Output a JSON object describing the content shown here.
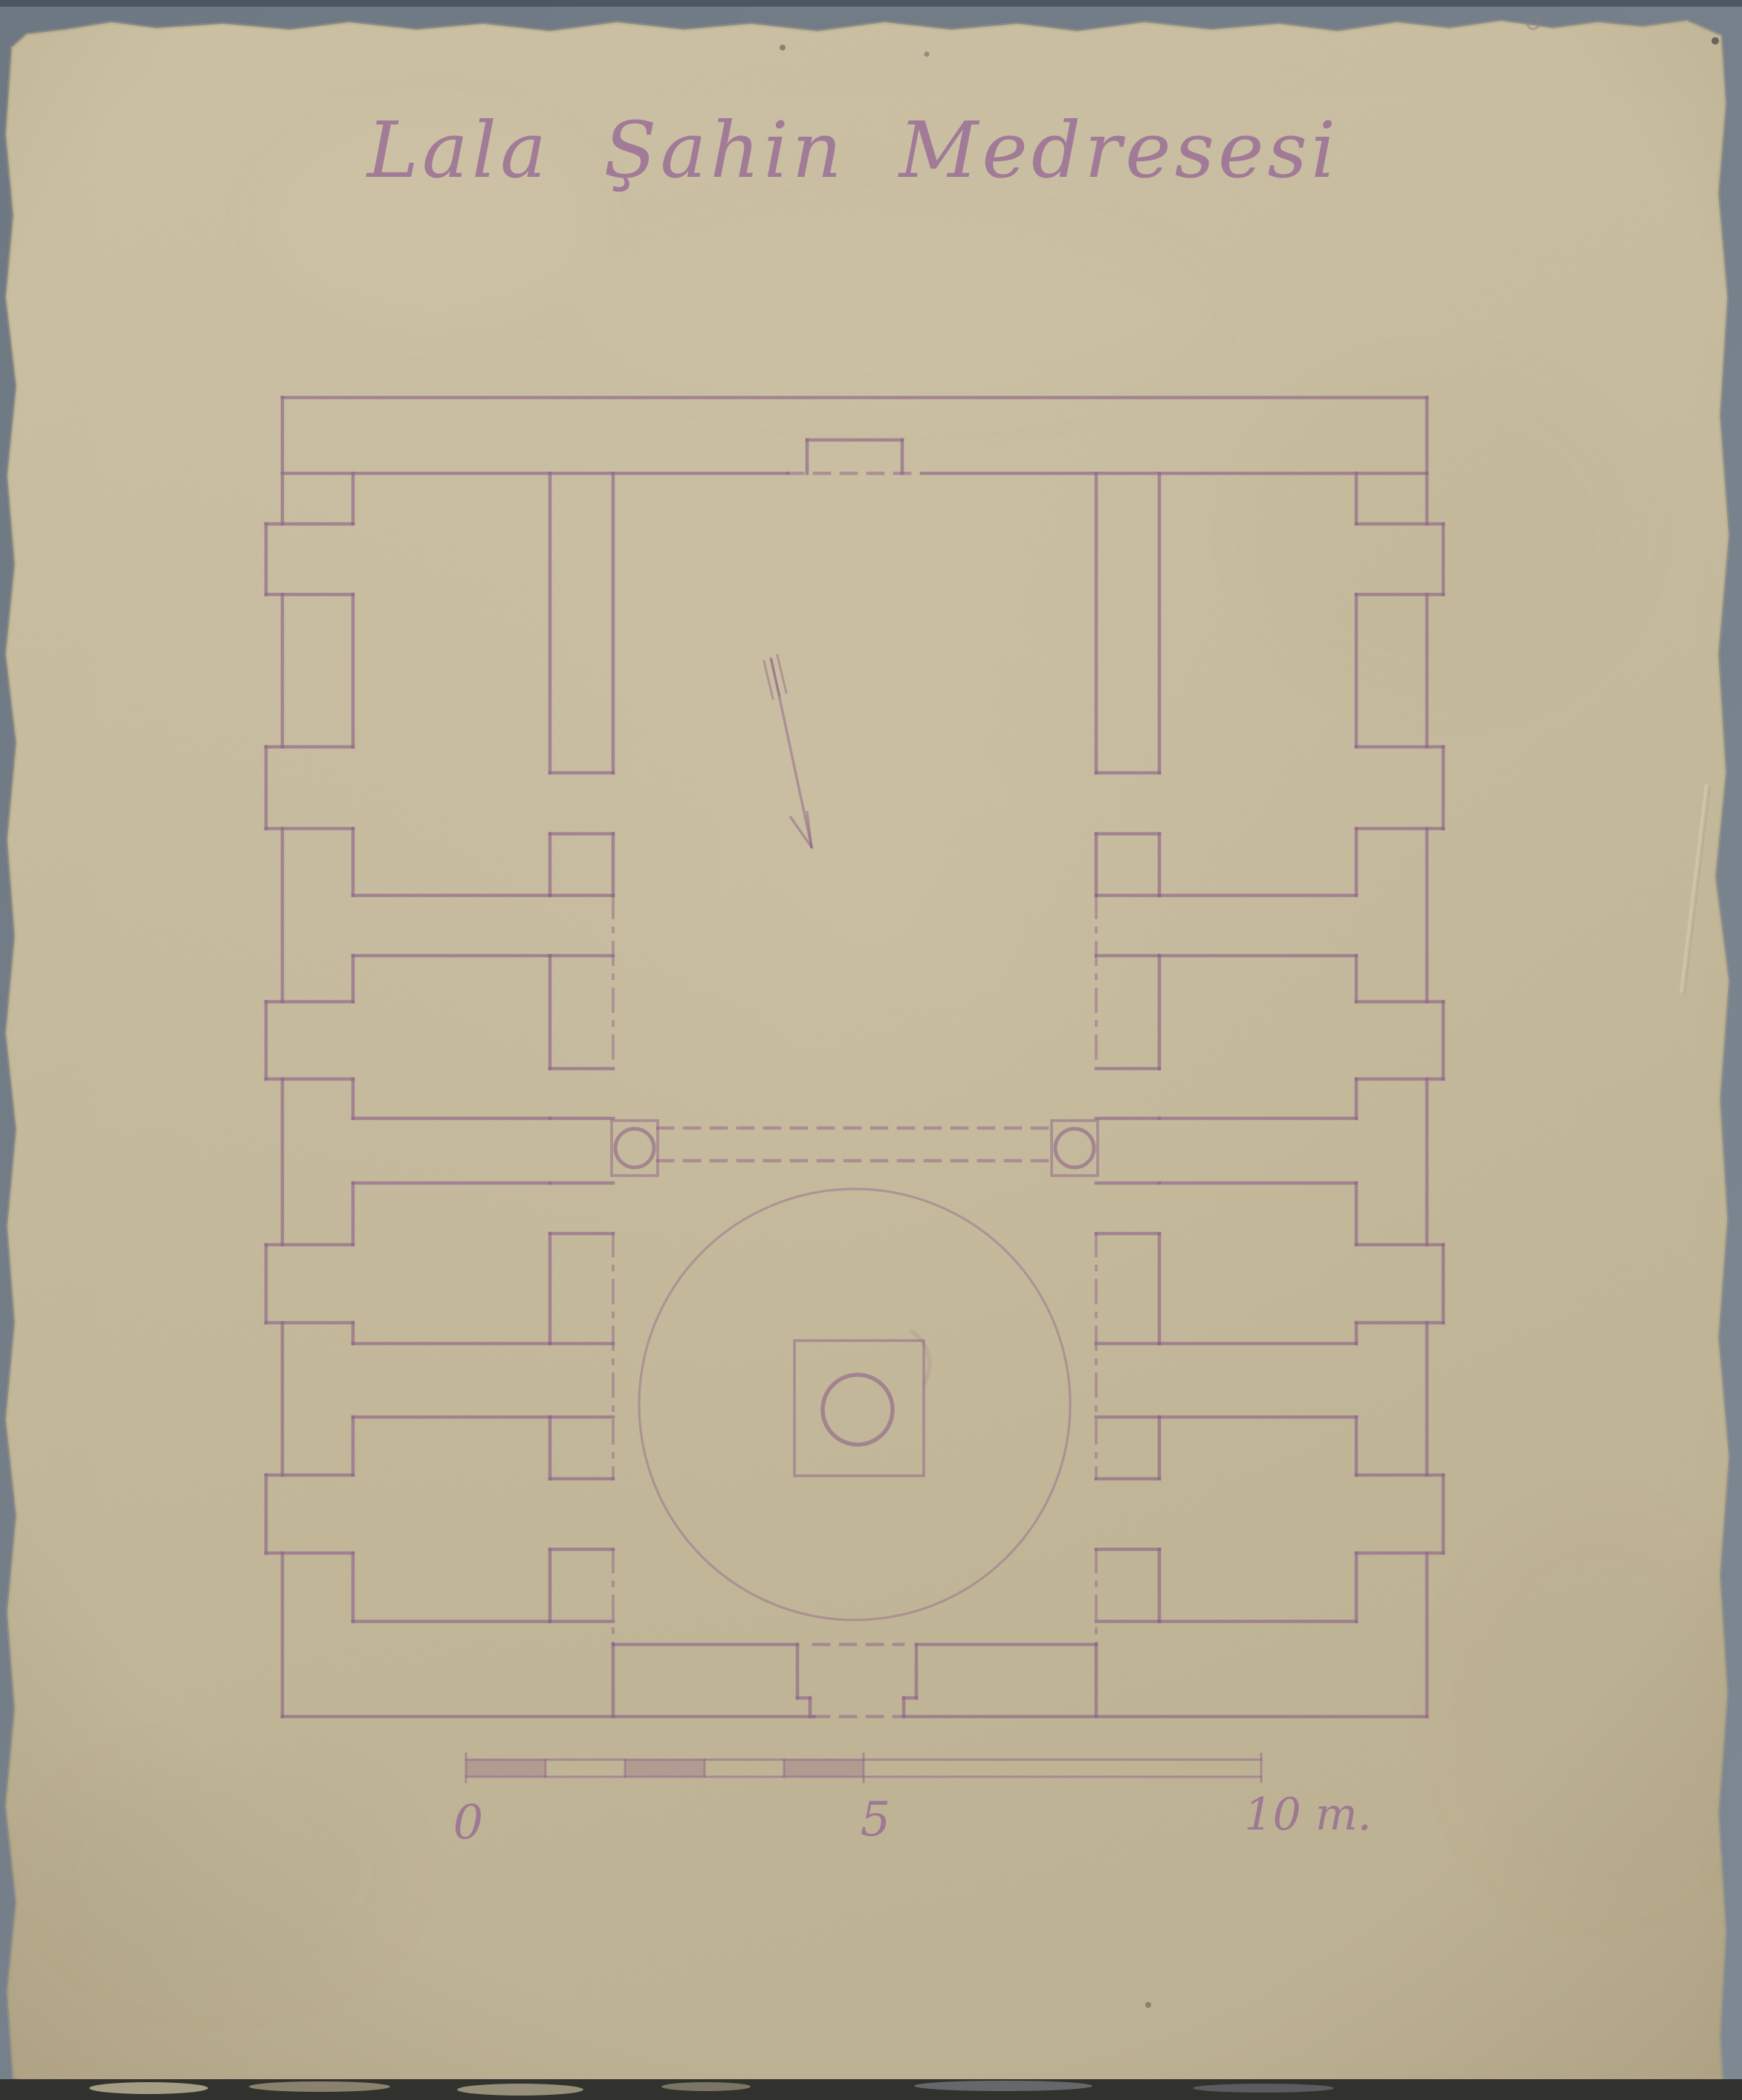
{
  "document": {
    "title": "Lala Şahin Medresesi",
    "scale_labels": {
      "zero": "0",
      "five": "5",
      "ten": "10 m."
    },
    "colors": {
      "background": "#75808b",
      "background_top_strip": "#49525c",
      "paper": "#cfc4a7",
      "paper_dark": "#c3b698",
      "ink": "#8d6287",
      "ink_faint": "#9c739a",
      "bottom_strip": "#31312d"
    }
  },
  "plan": {
    "wall_stroke_width": 4.6,
    "thin_stroke_width": 3.0,
    "solid_walls": [
      [
        380,
        535,
        1920,
        535
      ],
      [
        380,
        2310,
        1095,
        2310
      ],
      [
        1218,
        2310,
        1920,
        2310
      ],
      [
        380,
        535,
        380,
        705
      ],
      [
        380,
        800,
        380,
        1005
      ],
      [
        380,
        1115,
        380,
        1348
      ],
      [
        380,
        1452,
        380,
        1675
      ],
      [
        380,
        1780,
        380,
        1985
      ],
      [
        380,
        2090,
        380,
        2310
      ],
      [
        1920,
        535,
        1920,
        705
      ],
      [
        1920,
        800,
        1920,
        1005
      ],
      [
        1920,
        1115,
        1920,
        1348
      ],
      [
        1920,
        1452,
        1920,
        1675
      ],
      [
        1920,
        1780,
        1920,
        1985
      ],
      [
        1920,
        2090,
        1920,
        2310
      ],
      [
        380,
        637,
        1060,
        637
      ],
      [
        1240,
        637,
        1920,
        637
      ],
      [
        1086,
        592,
        1214,
        592
      ],
      [
        1086,
        592,
        1086,
        637
      ],
      [
        1214,
        592,
        1214,
        637
      ],
      [
        825,
        637,
        825,
        1040
      ],
      [
        825,
        1122,
        825,
        1205
      ],
      [
        1475,
        637,
        1475,
        1040
      ],
      [
        1475,
        1122,
        1475,
        1205
      ],
      [
        825,
        2213,
        1073,
        2213
      ],
      [
        1233,
        2213,
        1475,
        2213
      ],
      [
        825,
        2213,
        825,
        2310
      ],
      [
        1475,
        2213,
        1475,
        2310
      ],
      [
        1073,
        2213,
        1073,
        2285
      ],
      [
        1073,
        2285,
        1090,
        2285
      ],
      [
        1090,
        2285,
        1090,
        2310
      ],
      [
        1233,
        2213,
        1233,
        2285
      ],
      [
        1233,
        2285,
        1216,
        2285
      ],
      [
        1216,
        2285,
        1216,
        2310
      ],
      [
        475,
        637,
        475,
        705
      ],
      [
        475,
        800,
        475,
        1005
      ],
      [
        475,
        1115,
        475,
        1205
      ],
      [
        475,
        1205,
        740,
        1205
      ],
      [
        740,
        637,
        740,
        1040
      ],
      [
        740,
        1122,
        740,
        1205
      ],
      [
        475,
        1286,
        740,
        1286
      ],
      [
        475,
        1286,
        475,
        1348
      ],
      [
        475,
        1452,
        475,
        1505
      ],
      [
        475,
        1505,
        740,
        1505
      ],
      [
        740,
        1286,
        740,
        1438
      ],
      [
        475,
        1592,
        740,
        1592
      ],
      [
        475,
        1592,
        475,
        1675
      ],
      [
        475,
        1780,
        475,
        1808
      ],
      [
        475,
        1808,
        740,
        1808
      ],
      [
        740,
        1660,
        740,
        1808
      ],
      [
        475,
        1907,
        740,
        1907
      ],
      [
        475,
        1907,
        475,
        1985
      ],
      [
        475,
        2090,
        475,
        2182
      ],
      [
        475,
        2182,
        740,
        2182
      ],
      [
        740,
        1907,
        740,
        1990
      ],
      [
        740,
        2085,
        740,
        2182
      ],
      [
        1560,
        1205,
        1825,
        1205
      ],
      [
        1825,
        637,
        1825,
        705
      ],
      [
        1825,
        800,
        1825,
        1005
      ],
      [
        1825,
        1115,
        1825,
        1205
      ],
      [
        1560,
        637,
        1560,
        1040
      ],
      [
        1560,
        1122,
        1560,
        1205
      ],
      [
        1560,
        1286,
        1825,
        1286
      ],
      [
        1825,
        1286,
        1825,
        1348
      ],
      [
        1825,
        1452,
        1825,
        1505
      ],
      [
        1560,
        1505,
        1825,
        1505
      ],
      [
        1560,
        1286,
        1560,
        1438
      ],
      [
        1560,
        1592,
        1825,
        1592
      ],
      [
        1825,
        1592,
        1825,
        1675
      ],
      [
        1825,
        1780,
        1825,
        1808
      ],
      [
        1560,
        1808,
        1825,
        1808
      ],
      [
        1560,
        1660,
        1560,
        1808
      ],
      [
        1560,
        1907,
        1825,
        1907
      ],
      [
        1825,
        1907,
        1825,
        1985
      ],
      [
        1825,
        2090,
        1825,
        2182
      ],
      [
        1560,
        2182,
        1825,
        2182
      ],
      [
        1560,
        1907,
        1560,
        1990
      ],
      [
        1560,
        2085,
        1560,
        2182
      ],
      [
        740,
        1040,
        825,
        1040
      ],
      [
        740,
        1122,
        825,
        1122
      ],
      [
        740,
        1205,
        825,
        1205
      ],
      [
        740,
        1286,
        825,
        1286
      ],
      [
        740,
        1438,
        825,
        1438
      ],
      [
        740,
        1505,
        825,
        1505
      ],
      [
        740,
        1592,
        825,
        1592
      ],
      [
        740,
        1660,
        825,
        1660
      ],
      [
        740,
        1808,
        825,
        1808
      ],
      [
        740,
        1907,
        825,
        1907
      ],
      [
        740,
        1990,
        825,
        1990
      ],
      [
        740,
        2085,
        825,
        2085
      ],
      [
        740,
        2182,
        825,
        2182
      ],
      [
        1475,
        1040,
        1560,
        1040
      ],
      [
        1475,
        1122,
        1560,
        1122
      ],
      [
        1475,
        1205,
        1560,
        1205
      ],
      [
        1475,
        1286,
        1560,
        1286
      ],
      [
        1475,
        1438,
        1560,
        1438
      ],
      [
        1475,
        1505,
        1560,
        1505
      ],
      [
        1475,
        1592,
        1560,
        1592
      ],
      [
        1475,
        1660,
        1560,
        1660
      ],
      [
        1475,
        1808,
        1560,
        1808
      ],
      [
        1475,
        1907,
        1560,
        1907
      ],
      [
        1475,
        1990,
        1560,
        1990
      ],
      [
        1475,
        2085,
        1560,
        2085
      ],
      [
        1475,
        2182,
        1560,
        2182
      ],
      [
        358,
        705,
        475,
        705
      ],
      [
        358,
        800,
        475,
        800
      ],
      [
        358,
        705,
        358,
        800
      ],
      [
        358,
        1005,
        475,
        1005
      ],
      [
        358,
        1115,
        475,
        1115
      ],
      [
        358,
        1005,
        358,
        1115
      ],
      [
        358,
        1348,
        475,
        1348
      ],
      [
        358,
        1452,
        475,
        1452
      ],
      [
        358,
        1348,
        358,
        1452
      ],
      [
        358,
        1675,
        475,
        1675
      ],
      [
        358,
        1780,
        475,
        1780
      ],
      [
        358,
        1675,
        358,
        1780
      ],
      [
        358,
        1985,
        475,
        1985
      ],
      [
        358,
        2090,
        475,
        2090
      ],
      [
        358,
        1985,
        358,
        2090
      ],
      [
        1825,
        705,
        1942,
        705
      ],
      [
        1825,
        800,
        1942,
        800
      ],
      [
        1942,
        705,
        1942,
        800
      ],
      [
        1825,
        1005,
        1942,
        1005
      ],
      [
        1825,
        1115,
        1942,
        1115
      ],
      [
        1942,
        1005,
        1942,
        1115
      ],
      [
        1825,
        1348,
        1942,
        1348
      ],
      [
        1825,
        1452,
        1942,
        1452
      ],
      [
        1942,
        1348,
        1942,
        1452
      ],
      [
        1825,
        1675,
        1942,
        1675
      ],
      [
        1825,
        1780,
        1942,
        1780
      ],
      [
        1942,
        1675,
        1942,
        1780
      ],
      [
        1825,
        1985,
        1942,
        1985
      ],
      [
        1825,
        2090,
        1942,
        2090
      ],
      [
        1942,
        1985,
        1942,
        2090
      ]
    ],
    "dashed_lines": [
      [
        1060,
        637,
        1240,
        637
      ],
      [
        885,
        1518,
        1415,
        1518
      ],
      [
        885,
        1562,
        1415,
        1562
      ],
      [
        1095,
        2213,
        1215,
        2213
      ],
      [
        1095,
        2310,
        1215,
        2310
      ]
    ],
    "dashdot_lines": [
      [
        825,
        1205,
        825,
        1438
      ],
      [
        825,
        1660,
        825,
        1990
      ],
      [
        825,
        2085,
        825,
        2213
      ],
      [
        1475,
        1205,
        1475,
        1438
      ],
      [
        1475,
        1660,
        1475,
        1990
      ],
      [
        1475,
        2085,
        1475,
        2213
      ]
    ],
    "wall_rects": [
      [
        823,
        1508,
        62,
        74
      ],
      [
        1415,
        1508,
        62,
        74
      ],
      [
        1069,
        1804,
        174,
        182
      ]
    ],
    "circles": [
      [
        854,
        1545,
        26,
        5.0
      ],
      [
        1446,
        1545,
        26,
        5.0
      ],
      [
        1154,
        1897,
        47,
        5.5
      ]
    ],
    "pool_circle": [
      1150,
      1890,
      290,
      3.2
    ],
    "north_arrow": {
      "shaft": [
        1038,
        888,
        1092,
        1140
      ],
      "head": [
        [
          1092,
          1140,
          1064,
          1100
        ],
        [
          1092,
          1140,
          1086,
          1093
        ]
      ],
      "feathers": [
        [
          1028,
          890,
          1040,
          940
        ],
        [
          1037,
          886,
          1049,
          936
        ],
        [
          1046,
          882,
          1058,
          932
        ]
      ]
    },
    "scale_bar": {
      "rails": [
        [
          627,
          2368,
          1697,
          2368
        ],
        [
          627,
          2391,
          1697,
          2391
        ]
      ],
      "ticks": [
        [
          627,
          2360,
          627,
          2398
        ],
        [
          734,
          2368,
          734,
          2391
        ],
        [
          841,
          2368,
          841,
          2391
        ],
        [
          948,
          2368,
          948,
          2391
        ],
        [
          1055,
          2368,
          1055,
          2391
        ],
        [
          1162,
          2360,
          1162,
          2398
        ],
        [
          1697,
          2360,
          1697,
          2398
        ]
      ],
      "filled_units": [
        [
          627,
          2368,
          107,
          23
        ],
        [
          841,
          2368,
          107,
          23
        ],
        [
          1055,
          2368,
          107,
          23
        ]
      ]
    }
  }
}
